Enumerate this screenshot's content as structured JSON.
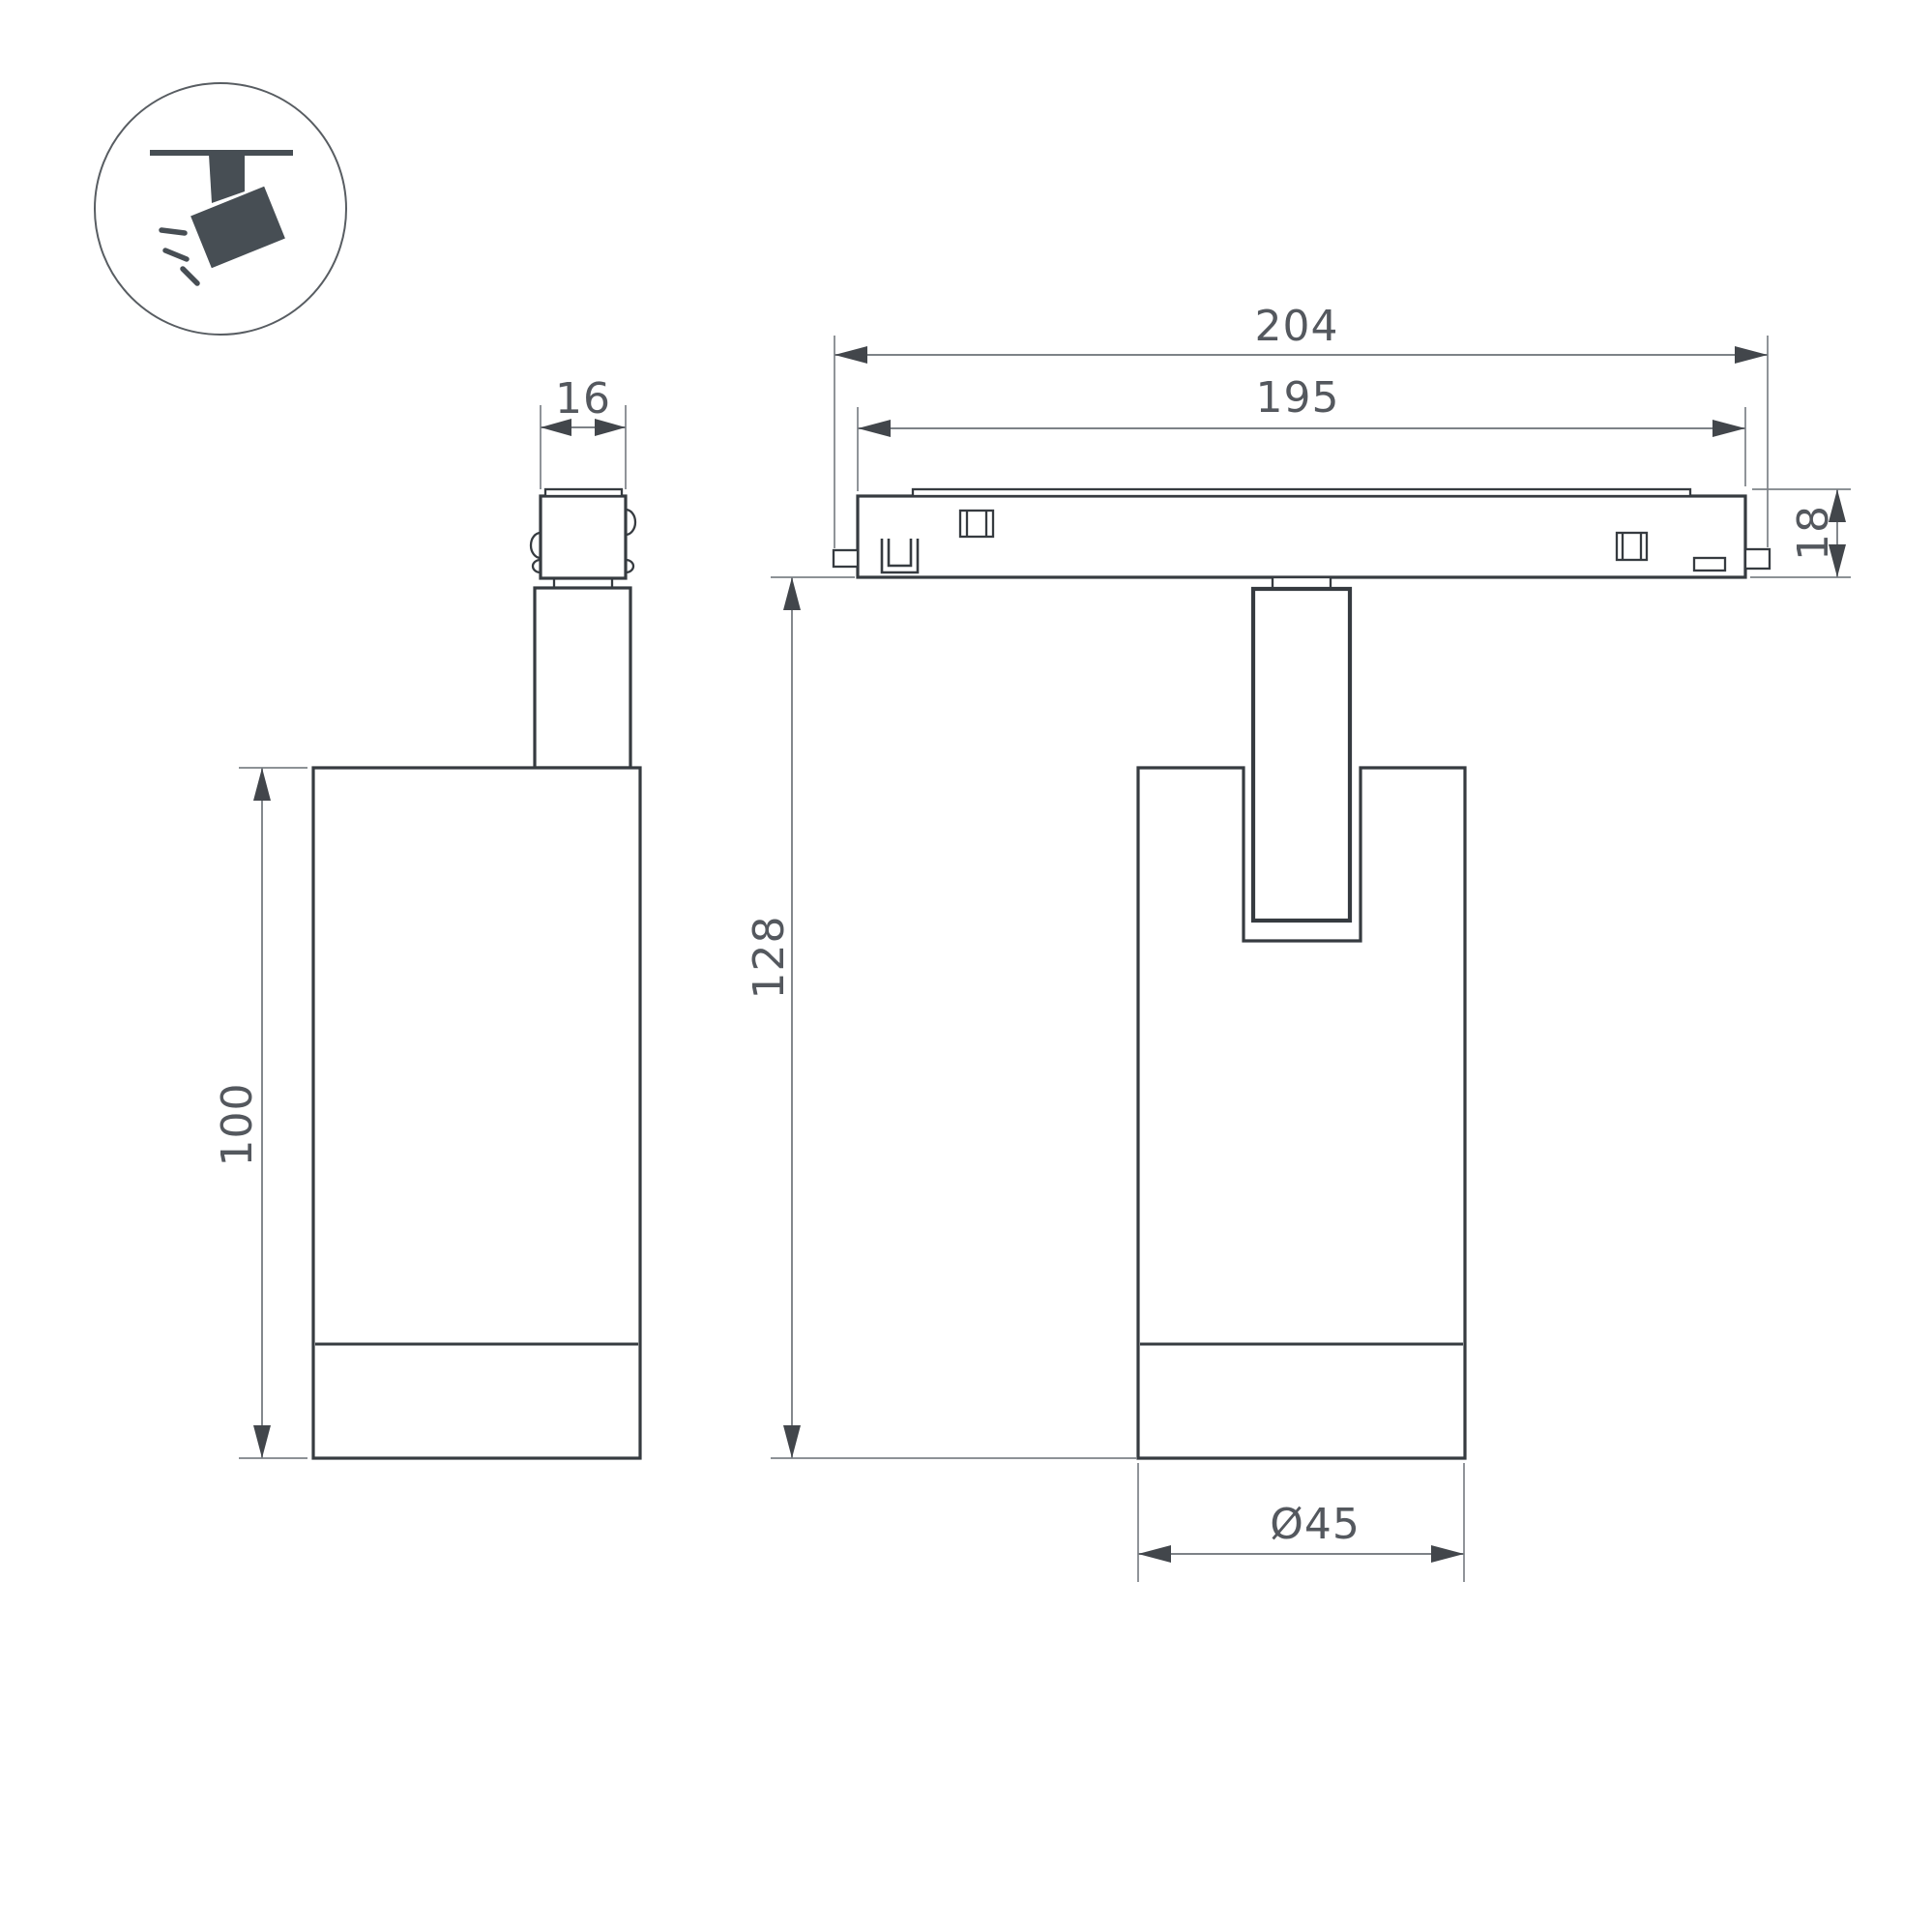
{
  "title": "Track spotlight dimension drawing",
  "colors": {
    "background": "#ffffff",
    "object_line": "#363b40",
    "dim_line": "#7d8287",
    "arrow": "#42464b",
    "text": "#54585e",
    "icon": "#474e54",
    "icon_circle": "#585d62"
  },
  "icon": {
    "name": "ceiling-track-spotlight-pictogram"
  },
  "views": {
    "side": {
      "name": "side view of spotlight with track connector"
    },
    "front": {
      "name": "front view of spotlight on track rail"
    }
  },
  "dimensions": {
    "connector_width": {
      "label": "16"
    },
    "track_length_outer": {
      "label": "204"
    },
    "track_length_inner": {
      "label": "195"
    },
    "track_height": {
      "label": "18"
    },
    "body_height": {
      "label": "100"
    },
    "total_height": {
      "label": "128"
    },
    "body_diameter": {
      "label": "Ø45"
    }
  }
}
